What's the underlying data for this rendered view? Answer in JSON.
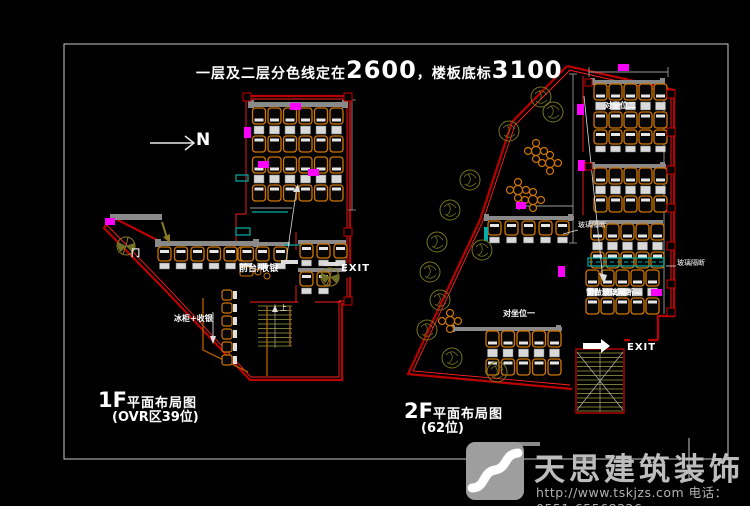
{
  "title": {
    "prefix": "一层及二层分色线定在",
    "num1": "2600",
    "mid": "，楼板底标",
    "num2": "3100"
  },
  "north": {
    "label": "N"
  },
  "plan1f": {
    "title_prefix": "1F",
    "title_rest": "平面布局图",
    "subtitle": "(OVR区39位)",
    "door": "门",
    "cashier": "前台/收银",
    "freezer": "冰柜+收银",
    "exit": "EXIT",
    "stairs_up": "上"
  },
  "plan2f": {
    "title_prefix": "2F",
    "title_rest": "平面布局图",
    "subtitle": "(62位)",
    "seat_row2": "对坐位二",
    "seat_row1": "对坐位一",
    "partition_a": "玻璃隔断",
    "partition_b": "玻璃隔断",
    "note": "需做玻璃隔断—",
    "exit": "EXIT"
  },
  "watermark": {
    "brand": "天思建筑装饰",
    "contact": "http://www.tskjzs.com 电话：0551-65568226"
  },
  "colors": {
    "wall_red": "#bb0000",
    "wall_red_bright": "#ff2020",
    "furniture_orange": "#cf7500",
    "marker_magenta": "#ff00ff",
    "glass_teal": "#00b0a8",
    "plant_olive": "#77771f",
    "bench_gray": "#8a8a8a",
    "frame_gray": "#c8c8c8",
    "background": "#000000"
  }
}
